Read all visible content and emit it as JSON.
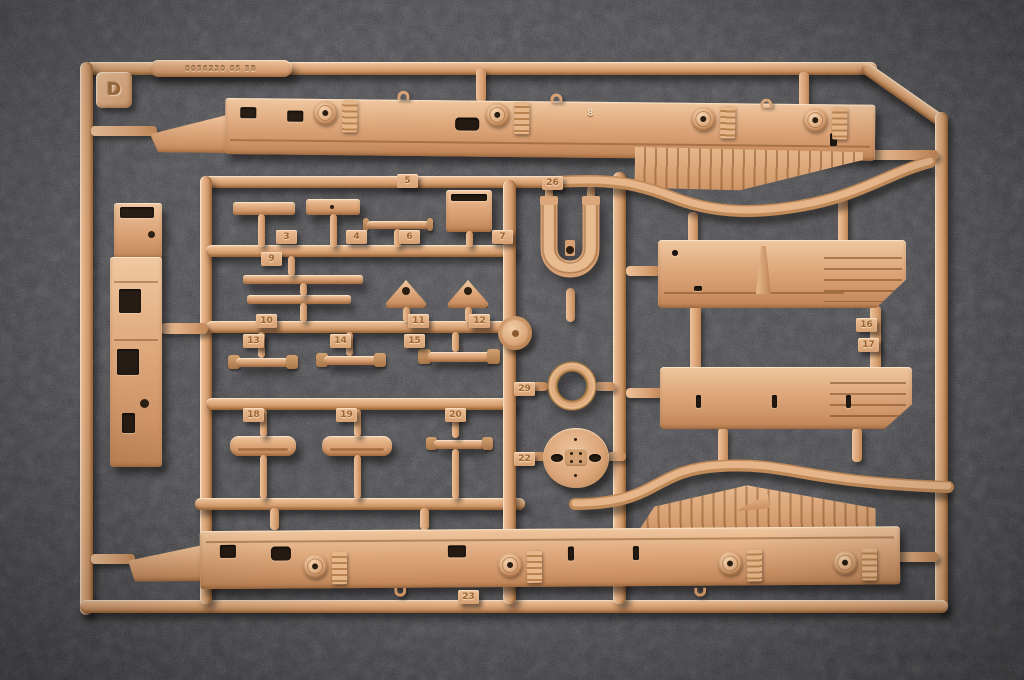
{
  "scene": {
    "type": "photograph",
    "subject": "Tan plastic injection-molded model kit sprue (parts tree) with chassis rails, equipment boxes and small fittings, lying on a dark gray speckled surface",
    "sprue_letter": "D",
    "embossed_code": "0056230 05 5B"
  },
  "part_tags": {
    "p3": "3",
    "p4": "4",
    "p5": "5",
    "p6": "6",
    "p7": "7",
    "p8": "8",
    "p9": "9",
    "p10": "10",
    "p11": "11",
    "p12": "12",
    "p13": "13",
    "p14": "14",
    "p15": "15",
    "p16": "16",
    "p17": "17",
    "p18": "18",
    "p19": "19",
    "p20": "20",
    "p22": "22",
    "p23": "23",
    "p26": "26",
    "p29": "29"
  },
  "colors": {
    "plastic_base": "#dfa87b",
    "plastic_highlight": "#f0c79f",
    "plastic_shadow": "#b8814f",
    "background": "#3d3d41",
    "part_shadow": "rgba(12,10,9,0.55)"
  }
}
